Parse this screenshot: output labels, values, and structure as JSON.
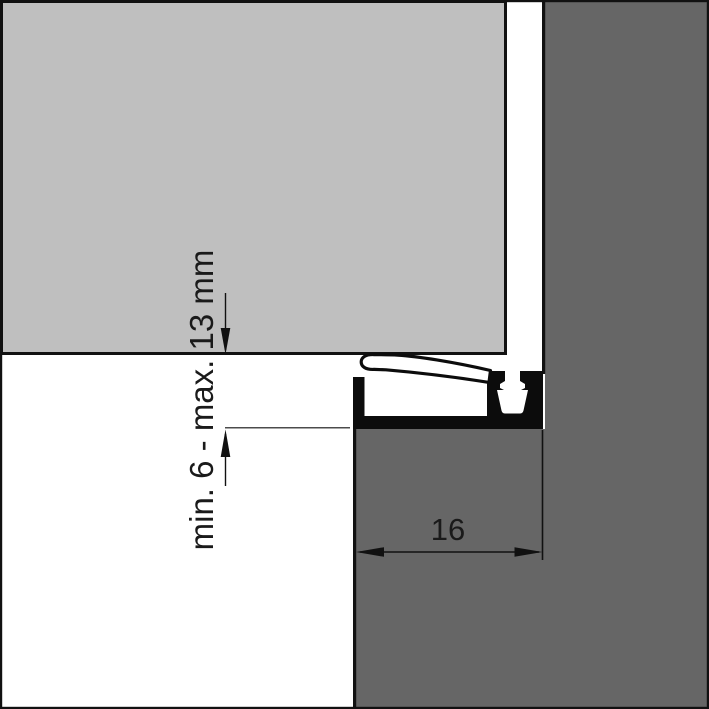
{
  "diagram": {
    "labels": {
      "gap_dimension": "min. 6 - max. 13 mm",
      "width_dimension": "16"
    },
    "colors": {
      "door_panel": "#bfbfbf",
      "wall_floor": "#666666",
      "background": "#ffffff",
      "line": "#111111"
    }
  }
}
